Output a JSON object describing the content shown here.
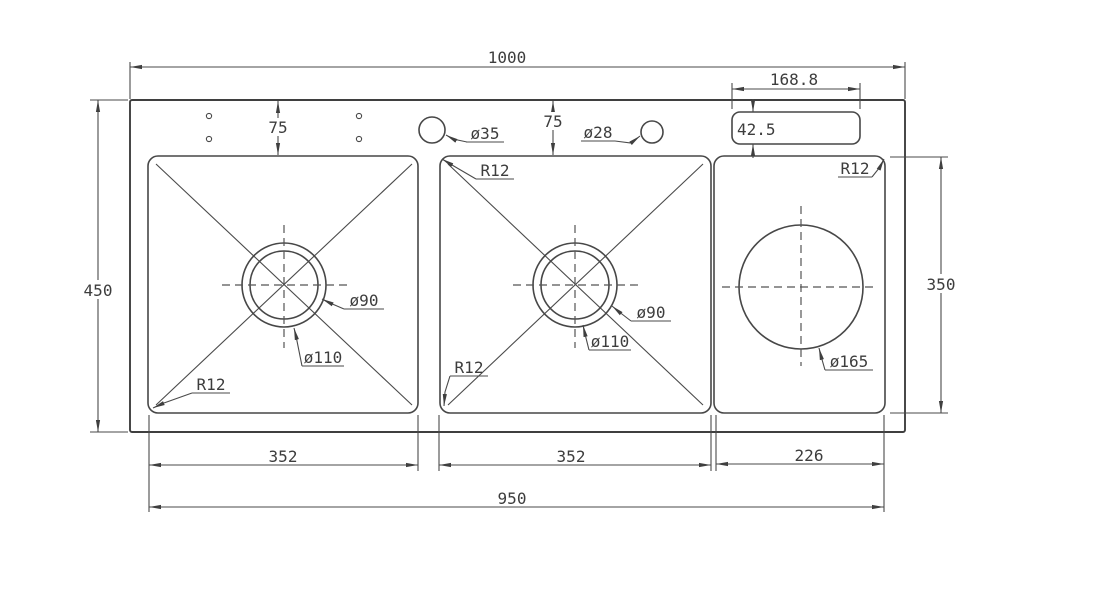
{
  "drawing": {
    "title": "triple-bowl-sink-top-view-dimension-drawing",
    "colors": {
      "background": "#ffffff",
      "line": "#3f3f3f",
      "text": "#3d3d3d"
    },
    "labels": {
      "overall_width": "1000",
      "overall_depth": "450",
      "deck_offset_left": "75",
      "deck_offset_right": "75",
      "faucet_hole_left": "ø35",
      "faucet_hole_right": "ø28",
      "tray_width": "168.8",
      "tray_depth": "42.5",
      "bowl1_width": "352",
      "bowl2_width": "352",
      "compartment3_width": "226",
      "compartment3_depth": "350",
      "bowls_total_width": "950",
      "bowl1_corner_radius": "R12",
      "bowl2_corner_radius_top": "R12",
      "bowl2_corner_radius_bottom": "R12",
      "compartment3_corner_radius": "R12",
      "bowl1_drain_rim": "ø90",
      "bowl1_drain_hole": "ø110",
      "bowl2_drain_rim": "ø90",
      "bowl2_drain_hole": "ø110",
      "compartment3_hole": "ø165"
    }
  }
}
